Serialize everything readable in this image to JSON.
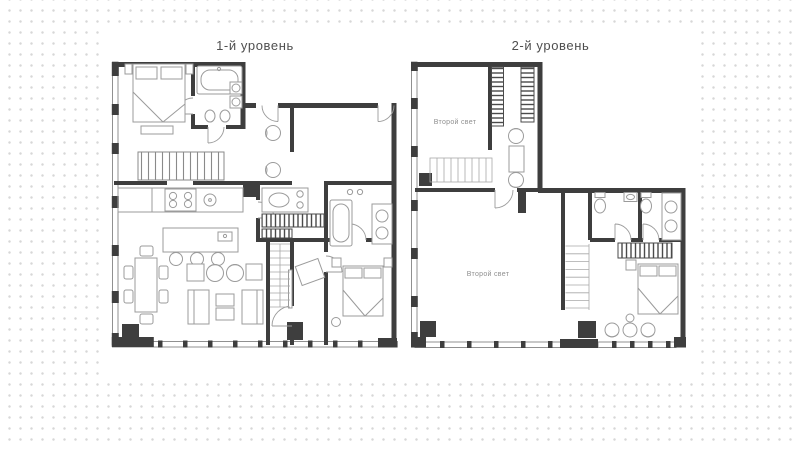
{
  "plans": {
    "level1": {
      "title": "1-й уровень"
    },
    "level2": {
      "title": "2-й уровень",
      "void_label_upper": "Второй свет",
      "void_label_lower": "Второй свет"
    }
  },
  "colors": {
    "wall": "#3e3e3e",
    "furniture_line": "#9b9b9b",
    "background_dot": "#d7d7d7",
    "sheet": "#ffffff",
    "void_label_text": "#8f8f8f",
    "title_text": "#4f4f4f"
  }
}
